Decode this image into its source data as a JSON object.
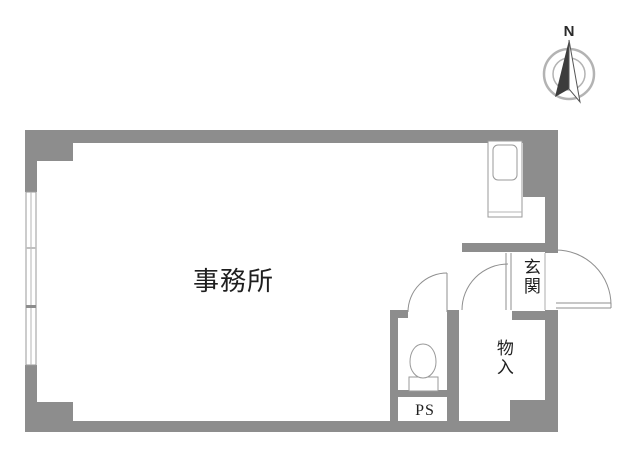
{
  "page": {
    "title": "事務所 間取り図",
    "background": "#ffffff"
  },
  "colors": {
    "wall": "#8d8d8d",
    "fixture_outline": "#9a9a9a",
    "door_line": "#8f8f8f",
    "compass_ring": "#b3b3b3",
    "compass_needle_dark": "#3c3c3c",
    "text": "#1f1f1f"
  },
  "rooms": {
    "office": {
      "label": "事務所"
    },
    "entrance": {
      "label": "玄関"
    },
    "storage": {
      "label": "物入"
    },
    "pipe_space": {
      "label": "PS"
    }
  },
  "compass": {
    "north_label": "N"
  },
  "icons": {
    "compass": "compass-north-icon",
    "toilet": "toilet-icon",
    "kitchen": "kitchen-sink-unit-icon",
    "window": "window-band-icon",
    "doors": [
      "toilet-door-swing-icon",
      "storage-door-swing-icon",
      "entrance-door-swing-icon"
    ]
  }
}
